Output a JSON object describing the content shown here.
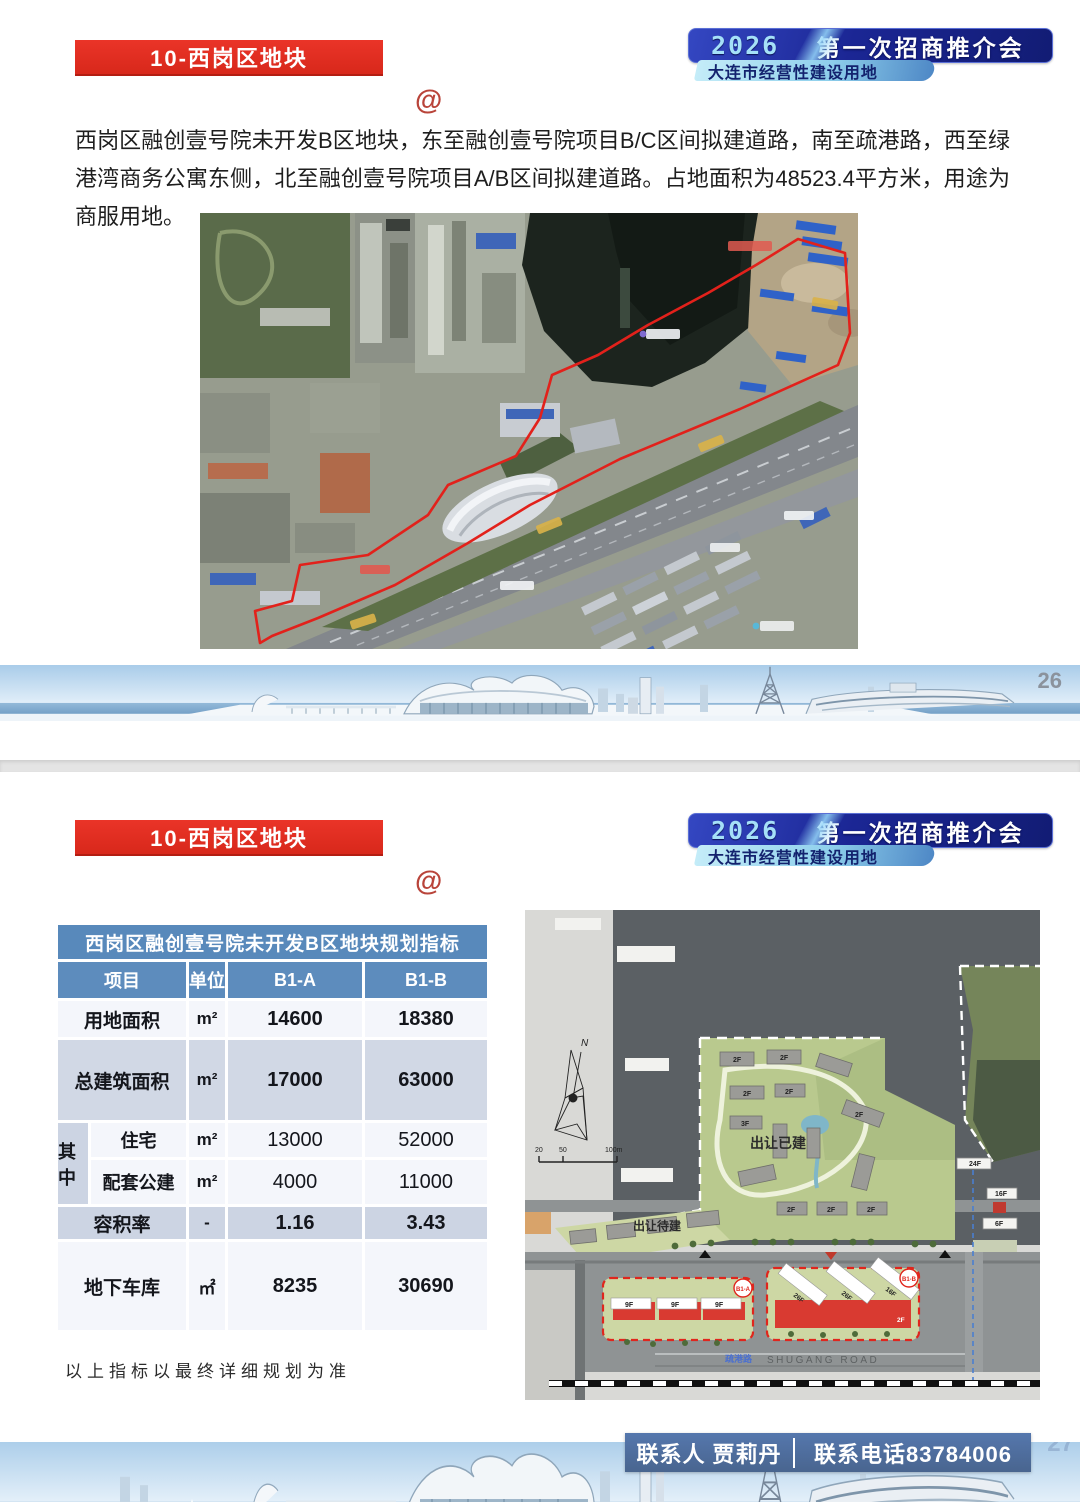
{
  "badge": {
    "year": "2026",
    "title": "第一次招商推介会",
    "subtitle": "大连市经营性建设用地"
  },
  "slide1": {
    "banner": "10-西岗区地块",
    "at": "@",
    "paragraph": "西岗区融创壹号院未开发B区地块，东至融创壹号院项目B/C区间拟建道路，南至疏港路，西至绿港湾商务公寓东侧，北至融创壹号院项目A/B区间拟建道路。占地面积为48523.4平方米，用途为商服用地。",
    "page_number": "26"
  },
  "slide2": {
    "banner": "10-西岗区地块",
    "at": "@",
    "page_number": "27",
    "table": {
      "title": "西岗区融创壹号院未开发B区地块规划指标",
      "headers": [
        "项目",
        "单位",
        "B1-A",
        "B1-B"
      ],
      "group_label": "其中",
      "rows": {
        "land_area": {
          "name": "用地面积",
          "unit": "m²",
          "b1a": "14600",
          "b1b": "18380"
        },
        "total_gfa": {
          "name": "总建筑面积",
          "unit": "m²",
          "b1a": "17000",
          "b1b": "63000"
        },
        "residential": {
          "name": "住宅",
          "unit": "m²",
          "b1a": "13000",
          "b1b": "52000"
        },
        "public_support": {
          "name": "配套公建",
          "unit": "m²",
          "b1a": "4000",
          "b1b": "11000"
        },
        "plot_ratio": {
          "name": "容积率",
          "unit": "-",
          "b1a": "1.16",
          "b1b": "3.43"
        },
        "garage": {
          "name": "地下车库",
          "unit": "㎡",
          "b1a": "8235",
          "b1b": "30690"
        }
      }
    },
    "note": "以上指标以最终详细规划为准",
    "siteplan": {
      "north": "N",
      "scale": {
        "t20": "20",
        "t50": "50",
        "t100": "100m"
      },
      "sold_built": "出让已建",
      "sold_pending": "出让待建",
      "parcel_a": "B1-A",
      "parcel_b": "B1-B",
      "road_cn": "疏港路",
      "road_en": "SHUGANG ROAD",
      "floors": {
        "f2": "2F",
        "f3": "3F",
        "f9": "9F",
        "f16": "16F",
        "f24": "24F",
        "f26": "26F",
        "f6": "6F"
      }
    },
    "contact": {
      "person": "联系人 贾莉丹",
      "phone": "联系电话83784006"
    }
  }
}
